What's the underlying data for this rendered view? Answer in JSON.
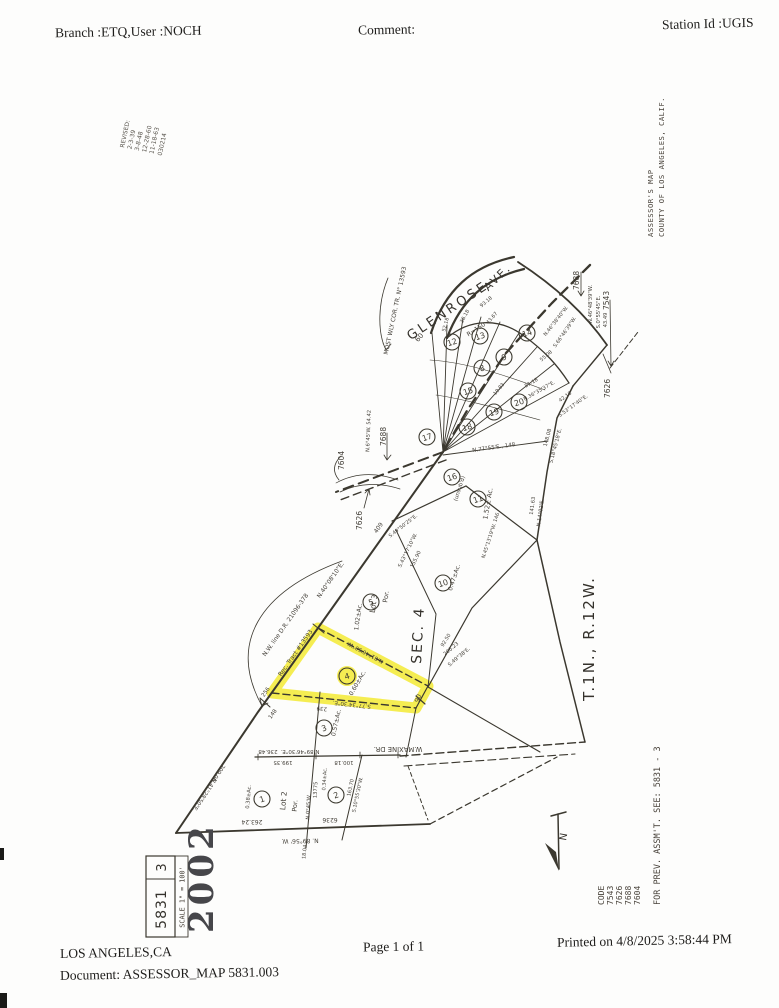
{
  "header": {
    "branch": "Branch :ETQ,User :NOCH",
    "comment": "Comment:",
    "station": "Station Id :UGIS"
  },
  "footer": {
    "city": "LOS ANGELES,CA",
    "document": "Document: ASSESSOR_MAP 5831.003",
    "page": "Page 1 of 1",
    "printed": "Printed on 4/8/2025 3:58:44 PM"
  },
  "map": {
    "street1": "GLENROSE",
    "street2": "AVE.",
    "section": "SEC. 4",
    "township": "T.1N., R.12W.",
    "assessor_line1": "ASSESSOR'S MAP",
    "assessor_line2": "COUNTY OF LOS ANGELES, CALIF.",
    "revised": [
      "REVISED:",
      "2-3-39",
      "3-8-48",
      "12-28-60",
      "11-18-63",
      "030214"
    ],
    "north_label": "N",
    "code_title": "CODE",
    "codes": [
      "7543",
      "7626",
      "7688",
      "7604"
    ],
    "prev_note": "FOR PREV. ASSM'T. SEE:  5831 - 3",
    "title_block": {
      "sheet": "5831",
      "page": "3",
      "scale": "SCALE 1\" = 100'",
      "stamp": "2002"
    },
    "highlight": {
      "color": "#f2e827",
      "points": "318,628 428,686 416,708 272,693",
      "circle": {
        "x": 347,
        "y": 676,
        "r": 10
      }
    },
    "parcels": [
      {
        "n": "1",
        "x": 262,
        "y": 799
      },
      {
        "n": "2",
        "x": 336,
        "y": 795
      },
      {
        "n": "3",
        "x": 324,
        "y": 728
      },
      {
        "n": "4",
        "x": 347,
        "y": 676
      },
      {
        "n": "5",
        "x": 371,
        "y": 602
      },
      {
        "n": "10",
        "x": 443,
        "y": 583
      },
      {
        "n": "11",
        "x": 478,
        "y": 499
      },
      {
        "n": "16",
        "x": 452,
        "y": 477
      },
      {
        "n": "17",
        "x": 427,
        "y": 437
      },
      {
        "n": "18",
        "x": 467,
        "y": 427
      },
      {
        "n": "15",
        "x": 468,
        "y": 391
      },
      {
        "n": "19",
        "x": 494,
        "y": 412
      },
      {
        "n": "20",
        "x": 519,
        "y": 402
      },
      {
        "n": "9",
        "x": 504,
        "y": 357
      },
      {
        "n": "8",
        "x": 482,
        "y": 368
      },
      {
        "n": "14",
        "x": 527,
        "y": 333
      },
      {
        "n": "13",
        "x": 480,
        "y": 336
      },
      {
        "n": "12",
        "x": 452,
        "y": 342
      }
    ],
    "callouts": [
      {
        "t": "7604",
        "x": 344,
        "y": 470
      },
      {
        "t": "7688",
        "x": 386,
        "y": 446
      },
      {
        "t": "7626",
        "x": 362,
        "y": 530
      },
      {
        "t": "7688",
        "x": 579,
        "y": 290
      },
      {
        "t": "7543",
        "x": 609,
        "y": 310
      },
      {
        "t": "7626",
        "x": 610,
        "y": 398
      }
    ],
    "labels": [
      {
        "t": "MOST WLY COR. TR. N° 13593",
        "x": 397,
        "y": 311,
        "r": -78,
        "s": 6
      },
      {
        "t": "60",
        "x": 421,
        "y": 339,
        "r": -50,
        "s": 7
      },
      {
        "t": "R=150",
        "x": 477,
        "y": 331,
        "r": -33,
        "s": 6
      },
      {
        "t": "93.18",
        "x": 487,
        "y": 303,
        "r": -40,
        "s": 5
      },
      {
        "t": "52.18",
        "x": 447,
        "y": 325,
        "r": -75,
        "s": 5
      },
      {
        "t": "36.18",
        "x": 466,
        "y": 317,
        "r": -62,
        "s": 5
      },
      {
        "t": "55.08",
        "x": 547,
        "y": 357,
        "r": -40,
        "s": 5
      },
      {
        "t": "43.67",
        "x": 493,
        "y": 319,
        "r": -48,
        "s": 5
      },
      {
        "t": "19.83",
        "x": 500,
        "y": 390,
        "r": -50,
        "s": 5
      },
      {
        "t": "N.46°38'40\"W.",
        "x": 557,
        "y": 322,
        "r": -52,
        "s": 5
      },
      {
        "t": "S.66°46'39\"W.",
        "x": 566,
        "y": 333,
        "r": -55,
        "s": 5
      },
      {
        "t": "N.46°48'39\"W.",
        "x": 592,
        "y": 304,
        "r": -90,
        "s": 5.2
      },
      {
        "t": "S.0°55'45\"E.",
        "x": 600,
        "y": 312,
        "r": -90,
        "s": 5.2
      },
      {
        "t": "43.49",
        "x": 607,
        "y": 320,
        "r": -90,
        "s": 5.2
      },
      {
        "t": "42.18",
        "x": 566,
        "y": 398,
        "r": -36,
        "s": 5
      },
      {
        "t": "S.53°17'40\"E.",
        "x": 574,
        "y": 407,
        "r": -36,
        "s": 5
      },
      {
        "t": "51.18",
        "x": 532,
        "y": 384,
        "r": -30,
        "s": 5
      },
      {
        "t": "N.36°35'37\"E.",
        "x": 540,
        "y": 392,
        "r": -30,
        "s": 5
      },
      {
        "t": "148.08",
        "x": 549,
        "y": 438,
        "r": -75,
        "s": 5.2
      },
      {
        "t": "S.18°45'18\"E.",
        "x": 557,
        "y": 446,
        "r": -75,
        "s": 5.2
      },
      {
        "t": "141.63",
        "x": 534,
        "y": 506,
        "r": -82,
        "s": 5.2
      },
      {
        "t": "N.14°02'E.",
        "x": 542,
        "y": 513,
        "r": -82,
        "s": 5.2
      },
      {
        "t": "N.45°13'19\"W.  146",
        "x": 492,
        "y": 536,
        "r": -72,
        "s": 5
      },
      {
        "t": "N.77°55'E.,  148",
        "x": 494,
        "y": 449,
        "r": -8,
        "s": 5.5
      },
      {
        "t": "(unsub'd)",
        "x": 461,
        "y": 489,
        "r": -72,
        "s": 5.5
      },
      {
        "t": "1.52± Ac.",
        "x": 490,
        "y": 504,
        "r": -80,
        "s": 6.5
      },
      {
        "t": "409",
        "x": 380,
        "y": 529,
        "r": -55,
        "s": 6
      },
      {
        "t": "S.49°50'25\"E.",
        "x": 404,
        "y": 527,
        "r": -38,
        "s": 5
      },
      {
        "t": "S.43°17'10\"W.",
        "x": 409,
        "y": 551,
        "r": -64,
        "s": 5.2
      },
      {
        "t": "155.90",
        "x": 417,
        "y": 560,
        "r": -64,
        "s": 5.2
      },
      {
        "t": "N.6°45'W.  54.42",
        "x": 370,
        "y": 431,
        "r": -88,
        "s": 5.2
      },
      {
        "t": "N.40°08'10\"E.",
        "x": 332,
        "y": 581,
        "r": -55,
        "s": 6
      },
      {
        "t": "N.W. line  D.R. 21096-378",
        "x": 287,
        "y": 626,
        "r": -55,
        "s": 6
      },
      {
        "t": "Rec. Tract  #13593",
        "x": 297,
        "y": 654,
        "r": -55,
        "s": 6
      },
      {
        "t": "256",
        "x": 267,
        "y": 693,
        "r": -55,
        "s": 5.5
      },
      {
        "t": "148",
        "x": 274,
        "y": 715,
        "r": -55,
        "s": 5.5
      },
      {
        "t": "N.41°28'50\"E.",
        "x": 203,
        "y": 794,
        "r": 124,
        "s": 5.5
      },
      {
        "t": "209.06",
        "x": 217,
        "y": 772,
        "r": 124,
        "s": 5.5
      },
      {
        "t": "1.02±Ac.",
        "x": 360,
        "y": 617,
        "r": -82,
        "s": 6
      },
      {
        "t": "Lot 3",
        "x": 376,
        "y": 604,
        "r": -82,
        "s": 7.5
      },
      {
        "t": "Por.",
        "x": 388,
        "y": 597,
        "r": -82,
        "s": 6.5
      },
      {
        "t": "0.47±Ac.",
        "x": 456,
        "y": 578,
        "r": -72,
        "s": 6
      },
      {
        "t": "92.50",
        "x": 447,
        "y": 641,
        "r": -58,
        "s": 5
      },
      {
        "t": "206.23",
        "x": 452,
        "y": 650,
        "r": -40,
        "s": 5.2
      },
      {
        "t": "S.49°38'E.",
        "x": 460,
        "y": 658,
        "r": -40,
        "s": 5.2
      },
      {
        "t": "N.81°46'50\"W.",
        "x": 366,
        "y": 651,
        "r": -152,
        "s": 5.5
      },
      {
        "t": "S.77°34'30\"E.",
        "x": 352,
        "y": 703,
        "r": -174,
        "s": 5.5
      },
      {
        "t": "239",
        "x": 322,
        "y": 707,
        "r": -174,
        "s": 5.5
      },
      {
        "t": "90",
        "x": 420,
        "y": 699,
        "r": -70,
        "s": 6.5
      },
      {
        "t": "0.60±Ac.",
        "x": 359,
        "y": 684,
        "r": -60,
        "s": 6
      },
      {
        "t": "0.57±Ac.",
        "x": 338,
        "y": 723,
        "r": -78,
        "s": 6
      },
      {
        "t": "W.MAXINE  DR.",
        "x": 398,
        "y": 747,
        "r": 180,
        "s": 6.8,
        "n": "street-maxine-label"
      },
      {
        "t": "236.48",
        "x": 268,
        "y": 750,
        "r": 180,
        "s": 5.5
      },
      {
        "t": "N.89°46'30\"E.",
        "x": 300,
        "y": 750,
        "r": 180,
        "s": 5.5
      },
      {
        "t": "199.35",
        "x": 283,
        "y": 761,
        "r": 180,
        "s": 5.5
      },
      {
        "t": "100.18",
        "x": 344,
        "y": 761,
        "r": 180,
        "s": 5.5
      },
      {
        "t": "Lot 2",
        "x": 286,
        "y": 801,
        "r": -85,
        "s": 7.5
      },
      {
        "t": "Por.",
        "x": 297,
        "y": 806,
        "r": -85,
        "s": 6.5
      },
      {
        "t": "0.38±Ac.",
        "x": 250,
        "y": 797,
        "r": -85,
        "s": 5.2
      },
      {
        "t": "0.34±Ac.",
        "x": 326,
        "y": 779,
        "r": -87,
        "s": 5
      },
      {
        "t": "13775",
        "x": 317,
        "y": 790,
        "r": -87,
        "s": 5.2
      },
      {
        "t": "N.0°45'W.",
        "x": 310,
        "y": 807,
        "r": -87,
        "s": 5.2
      },
      {
        "t": "163.70",
        "x": 352,
        "y": 788,
        "r": -78,
        "s": 5
      },
      {
        "t": "S.10°55'30\"W.",
        "x": 359,
        "y": 795,
        "r": -78,
        "s": 5
      },
      {
        "t": "263.24",
        "x": 252,
        "y": 820,
        "r": 180,
        "s": 6
      },
      {
        "t": "6236",
        "x": 330,
        "y": 818,
        "r": 180,
        "s": 6
      },
      {
        "t": "N. 89°56' W.",
        "x": 300,
        "y": 839,
        "r": 179,
        "s": 6
      },
      {
        "t": "18.04",
        "x": 306,
        "y": 852,
        "r": -85,
        "s": 5
      }
    ]
  }
}
